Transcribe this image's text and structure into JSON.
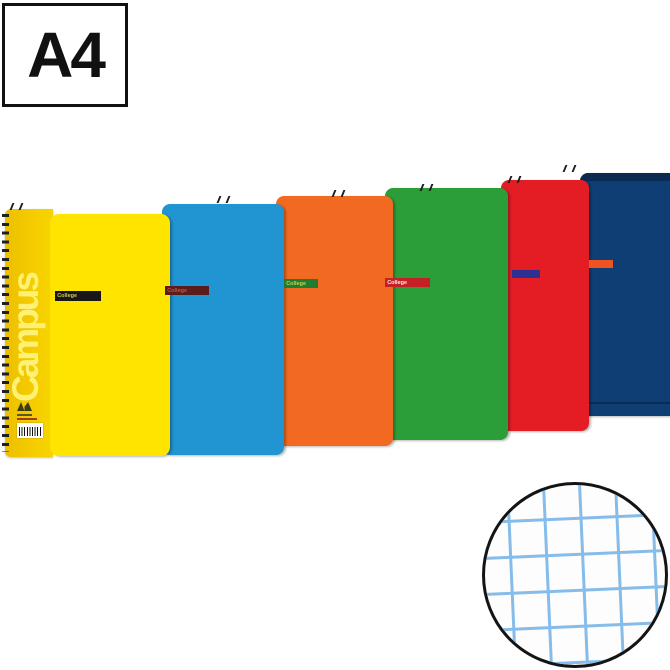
{
  "size_label": {
    "text": "A4"
  },
  "product": {
    "brand_vertical_text": "Campus",
    "notebooks": [
      {
        "color_name": "yellow",
        "cover_color": "#ffe400",
        "spine_color": "#f3c800",
        "band_color": "#171717",
        "band_label": "College",
        "band_label_color": "#d9c94f"
      },
      {
        "color_name": "blue",
        "cover_color": "#2194d2",
        "band_color": "#5a1d1b",
        "band_label": "College",
        "band_label_color": "#c2553b"
      },
      {
        "color_name": "orange",
        "cover_color": "#f26a22",
        "band_color": "#1f7c31",
        "band_label": "College",
        "band_label_color": "#c8d24e"
      },
      {
        "color_name": "green",
        "cover_color": "#2b9e39",
        "band_color": "#c52025",
        "band_label": "College",
        "band_label_color": "#f4ece6"
      },
      {
        "color_name": "red",
        "cover_color": "#e41d25",
        "band_color": "#2e3192",
        "band_label": ""
      },
      {
        "color_name": "navy",
        "cover_color": "#0f3e75",
        "band_color": "#f05323",
        "band_label": ""
      }
    ],
    "spiral_binding": "black wire coil on left edge",
    "barcode_present": true
  },
  "detail_circle": {
    "pattern": "squared-grid-paper",
    "grid_line_color": "#86bce9",
    "ring_color": "#141414"
  }
}
